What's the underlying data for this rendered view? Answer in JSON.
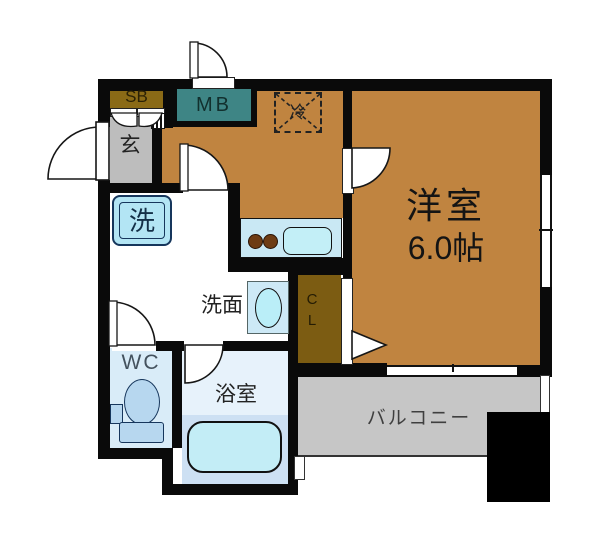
{
  "floorplan": {
    "title": "1K apartment floor plan",
    "rooms": {
      "shoe_box": "SB",
      "meter_box": "MB",
      "refrigerator": "冷",
      "entrance": "玄",
      "washing_machine": "洗",
      "powder_room": "洗面",
      "closet_c": "C",
      "closet_l": "L",
      "western_room_name": "洋室",
      "western_room_size": "6.0帖",
      "toilet": "WC",
      "bathroom": "浴室",
      "balcony": "バルコニー"
    },
    "colors": {
      "wall": "#0a0a0a",
      "wood_floor": "#c08440",
      "genkan_gray": "#bdbdbd",
      "shoe_box_brown": "#8a6a16",
      "meter_box_teal": "#3e8585",
      "closet_brown": "#7c5c12",
      "wet_room_blue": "#d9ecf8",
      "bath_upper_blue": "#e7f2fb",
      "bath_lower_blue": "#cde0f3",
      "fixture_cyan": "#c3eff7",
      "counter_blue": "#c9e8f4",
      "balcony_gray": "#c6c6c6",
      "burner_brown": "#6e3c14"
    }
  }
}
